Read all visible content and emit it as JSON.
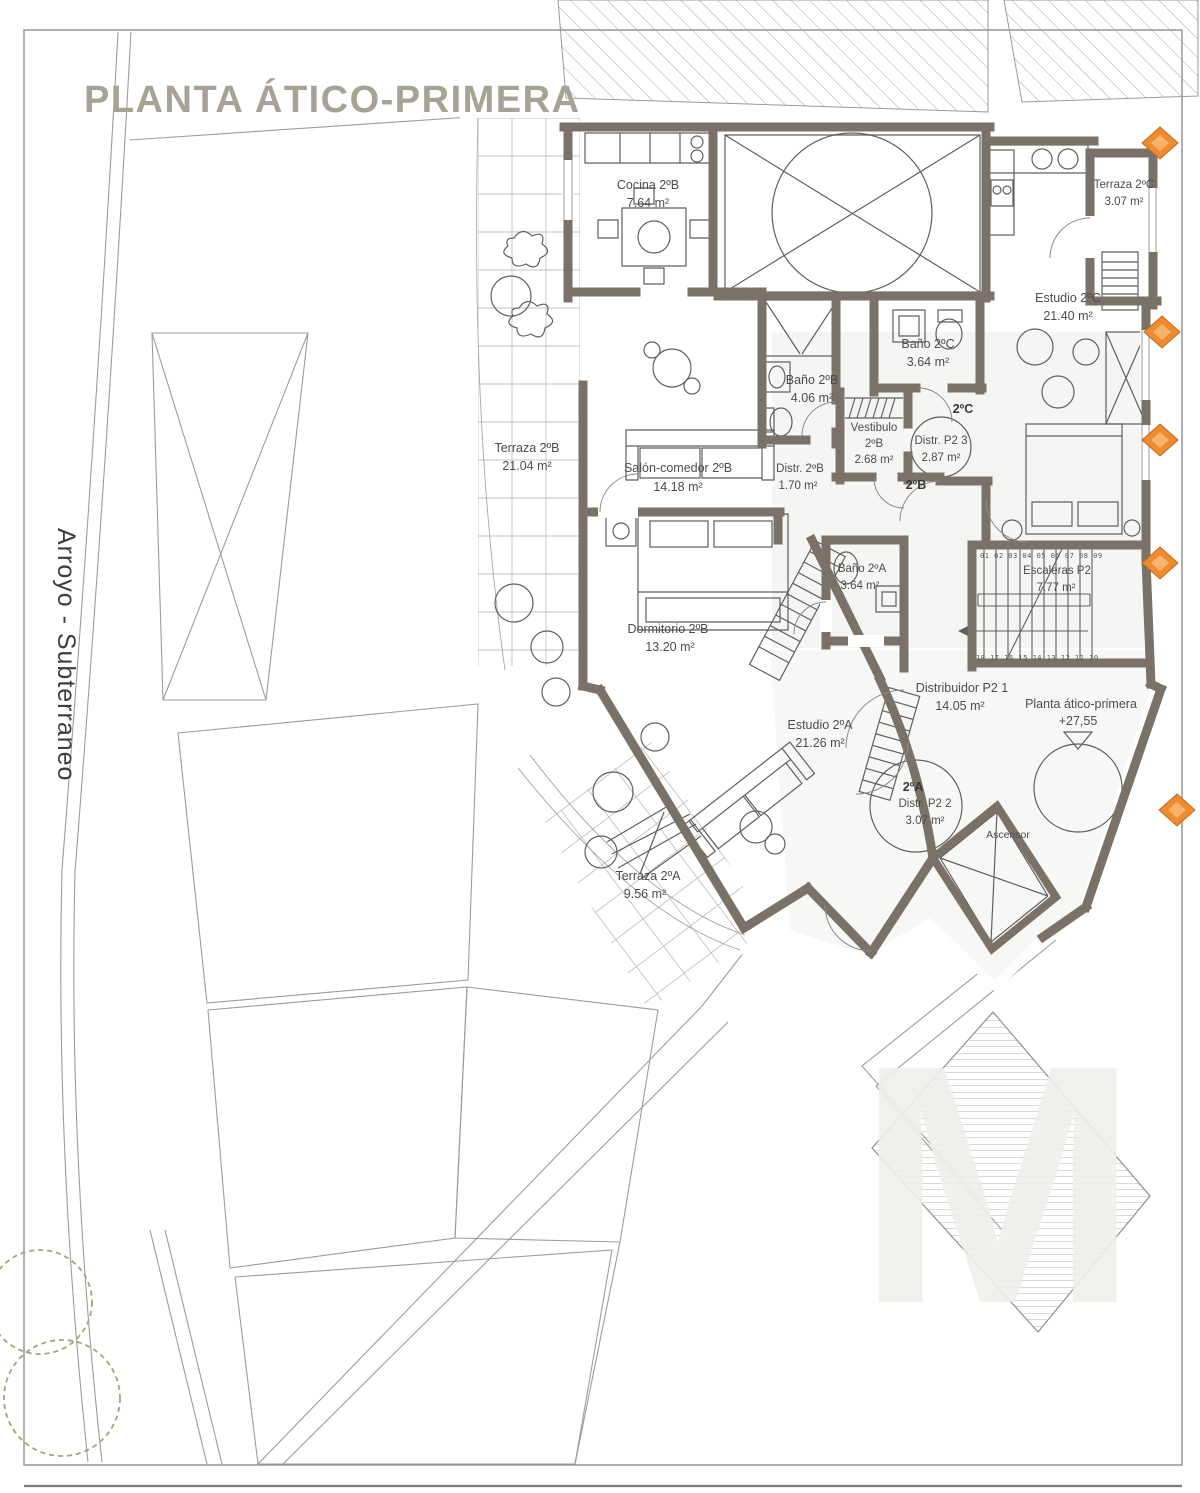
{
  "title": "PLANTA ÁTICO-PRIMERA",
  "street_label": "Arroyo - Subterraneo",
  "watermark": "M",
  "level": {
    "label": "Planta ático-primera",
    "elevation": "+27,55"
  },
  "unit_tags": {
    "a": "2ºA",
    "b": "2ºB",
    "c": "2ºC"
  },
  "stairs": {
    "top_numbers": "01 02 03 04 05 06 07 08 09",
    "bottom_numbers": "18 17 16 15 14 13 12 11 10"
  },
  "rooms": {
    "cocina_2b": {
      "name": "Cocina 2ºB",
      "area": "7.64 m²"
    },
    "terraza_2c": {
      "name": "Terraza 2ºC",
      "area": "3.07 m²"
    },
    "estudio_2c": {
      "name": "Estudio 2ºC",
      "area": "21.40 m²"
    },
    "bano_2c": {
      "name": "Baño 2ºC",
      "area": "3.64 m²"
    },
    "bano_2b": {
      "name": "Baño 2ºB",
      "area": "4.06 m²"
    },
    "vestibulo_2b": {
      "name": "Vestibulo",
      "unit": "2ºB",
      "area": "2.68 m²"
    },
    "distr_p2_3": {
      "name": "Distr. P2 3",
      "area": "2.87 m²"
    },
    "distr_2b": {
      "name": "Distr. 2ºB",
      "area": "1.70 m²"
    },
    "terraza_2b": {
      "name": "Terraza 2ºB",
      "area": "21.04 m²"
    },
    "salon_2b": {
      "name": "Salón-comedor 2ºB",
      "area": "14.18 m²"
    },
    "dormitorio_2b": {
      "name": "Dormitorio 2ºB",
      "area": "13.20 m²"
    },
    "bano_2a": {
      "name": "Baño 2ºA",
      "area": "3.64 m²"
    },
    "escaleras": {
      "name": "Escaleras P2",
      "area": "7.77 m²"
    },
    "distribuidor_p2_1": {
      "name": "Distribuidor P2 1",
      "area": "14.05 m²"
    },
    "estudio_2a": {
      "name": "Estudio 2ºA",
      "area": "21.26 m²"
    },
    "distr_p2_2": {
      "name": "Distr. P2 2",
      "unit": "2ºA",
      "area": "3.07 m²"
    },
    "terraza_2a": {
      "name": "Terraza 2ºA",
      "area": "9.56 m²"
    },
    "ascensor": {
      "name": "Ascensor"
    }
  },
  "colors": {
    "wall": "#7a7268",
    "title_text": "#a8a296",
    "axis_marker": "#ee8a2f",
    "tree": "#9aa87c",
    "label_text": "#4c4c4c"
  }
}
